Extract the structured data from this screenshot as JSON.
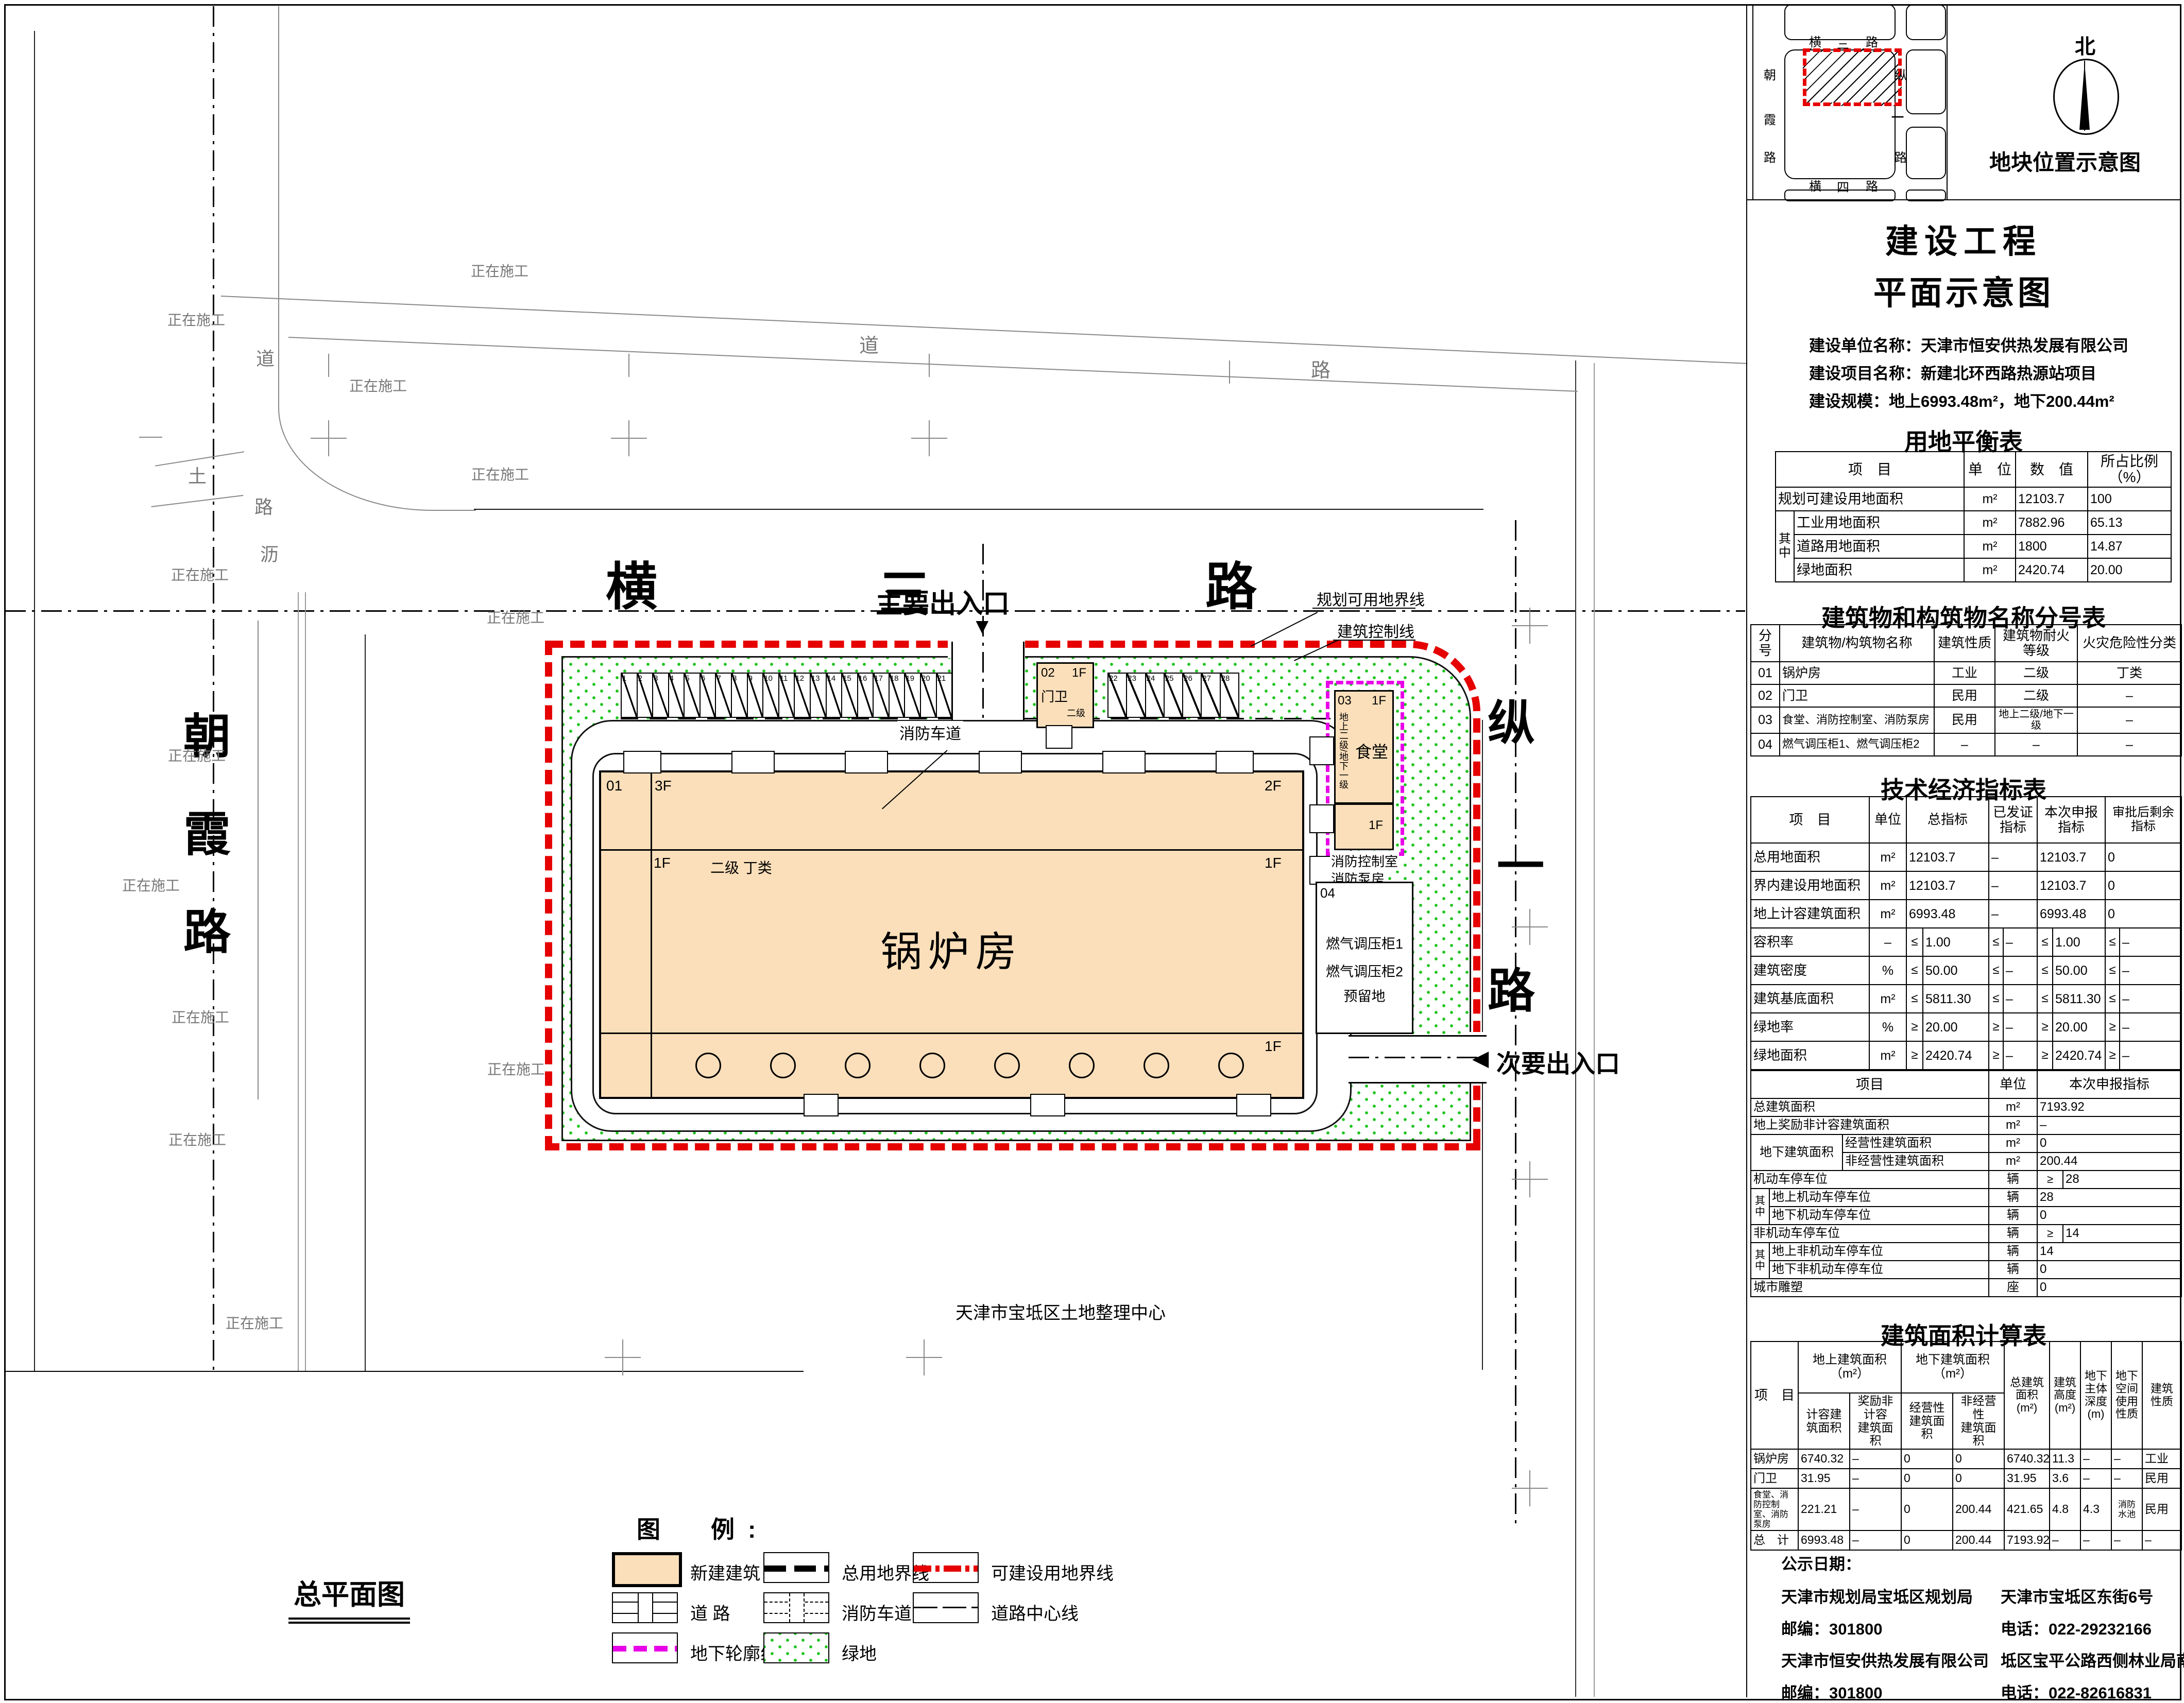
{
  "plan": {
    "under_construction": "正在施工",
    "land_center": "天津市宝坻区土地整理中心",
    "site_plan_title": "总平面图",
    "main_entrance": "主要出入口",
    "secondary_entrance": "次要出入口",
    "boundary_label_1": "规划可用地界线",
    "boundary_label_2": "建筑控制线",
    "fire_lane_label": "消防车道",
    "roads": {
      "heng3": [
        "横",
        "三",
        "路"
      ],
      "zong1": [
        "纵",
        "一",
        "路"
      ],
      "chaoxia": [
        "朝",
        "霞",
        "路"
      ],
      "dirt": "土",
      "dao": "道",
      "lu": "路",
      "li": "沥"
    },
    "boiler": {
      "code": "01",
      "f3": "3F",
      "f2": "2F",
      "f1": "1F",
      "grade": "二级 丁类",
      "name": "锅炉房"
    },
    "guard": {
      "code": "02",
      "f1": "1F",
      "name": "门卫",
      "grade": "二级"
    },
    "canteen": {
      "code": "03",
      "f1": "1F",
      "name": "食堂",
      "grade_note": "地上二级/地下一级",
      "fire_ctrl": "消防控制室",
      "fire_pump": "消防泵房"
    },
    "gas": {
      "code": "04",
      "line1": "燃气调压柜1",
      "line2": "燃气调压柜2",
      "line3": "预留地"
    },
    "parking_row_a": [
      "1",
      "2",
      "3",
      "4",
      "5",
      "6",
      "7",
      "8",
      "9",
      "10",
      "11",
      "12",
      "13",
      "14",
      "15",
      "16",
      "17",
      "18",
      "19",
      "20",
      "21"
    ],
    "parking_row_b": [
      "22",
      "23",
      "24",
      "25",
      "26",
      "27",
      "28"
    ]
  },
  "minimap": {
    "title": "地块位置示意图",
    "north": "北",
    "heng3": [
      "横",
      "三",
      "路"
    ],
    "heng4": [
      "横",
      "四",
      "路"
    ],
    "chaoxia": [
      "朝",
      "霞",
      "路"
    ],
    "zong1_top": "纵",
    "zong1_mid": "一",
    "zong1_bot": "路"
  },
  "titleblock": {
    "line1": "建设工程",
    "line2": "平面示意图",
    "info": [
      "建设单位名称：天津市恒安供热发展有限公司",
      "建设项目名称：新建北环西路热源站项目",
      "建设规模：地上6993.48m²，地下200.44m²"
    ]
  },
  "tables": {
    "land_balance": {
      "title": "用地平衡表",
      "headers": [
        "项　目",
        "单　位",
        "数　值",
        "所占比例（%）"
      ],
      "qizhong": "其中",
      "rows": [
        {
          "item": "规划可建设用地面积",
          "unit": "m²",
          "value": "12103.7",
          "pct": "100"
        },
        {
          "item": "工业用地面积",
          "unit": "m²",
          "value": "7882.96",
          "pct": "65.13"
        },
        {
          "item": "道路用地面积",
          "unit": "m²",
          "value": "1800",
          "pct": "14.87"
        },
        {
          "item": "绿地面积",
          "unit": "m²",
          "value": "2420.74",
          "pct": "20.00"
        }
      ]
    },
    "buildings": {
      "title": "建筑物和构筑物名称分号表",
      "headers": [
        "分号",
        "建筑物/构筑物名称",
        "建筑性质",
        "建筑物耐火等级",
        "火灾危险性分类"
      ],
      "rows": [
        [
          "01",
          "锅炉房",
          "工业",
          "二级",
          "丁类"
        ],
        [
          "02",
          "门卫",
          "民用",
          "二级",
          "–"
        ],
        [
          "03",
          "食堂、消防控制室、消防泵房",
          "民用",
          "地上二级/地下一级",
          "–"
        ],
        [
          "04",
          "燃气调压柜1、燃气调压柜2",
          "–",
          "–",
          "–"
        ]
      ]
    },
    "tech": {
      "title": "技术经济指标表",
      "headers": [
        "项　目",
        "单位",
        "总指标",
        "已发证指标",
        "本次申报指标",
        "审批后剩余指标"
      ],
      "upper_rows": [
        {
          "label": "总用地面积",
          "unit": "m²",
          "cells": [
            [
              "",
              "12103.7"
            ],
            [
              "",
              "–"
            ],
            [
              "",
              "12103.7"
            ],
            [
              "",
              "0"
            ]
          ]
        },
        {
          "label": "界内建设用地面积",
          "unit": "m²",
          "cells": [
            [
              "",
              "12103.7"
            ],
            [
              "",
              "–"
            ],
            [
              "",
              "12103.7"
            ],
            [
              "",
              "0"
            ]
          ]
        },
        {
          "label": "地上计容建筑面积",
          "unit": "m²",
          "cells": [
            [
              "",
              "6993.48"
            ],
            [
              "",
              "–"
            ],
            [
              "",
              "6993.48"
            ],
            [
              "",
              "0"
            ]
          ]
        },
        {
          "label": "容积率",
          "unit": "–",
          "cells": [
            [
              "≤",
              "1.00"
            ],
            [
              "≤",
              "–"
            ],
            [
              "≤",
              "1.00"
            ],
            [
              "≤",
              "–"
            ]
          ]
        },
        {
          "label": "建筑密度",
          "unit": "%",
          "cells": [
            [
              "≤",
              "50.00"
            ],
            [
              "≤",
              "–"
            ],
            [
              "≤",
              "50.00"
            ],
            [
              "≤",
              "–"
            ]
          ]
        },
        {
          "label": "建筑基底面积",
          "unit": "m²",
          "cells": [
            [
              "≤",
              "5811.30"
            ],
            [
              "≤",
              "–"
            ],
            [
              "≤",
              "5811.30"
            ],
            [
              "≤",
              "–"
            ]
          ]
        },
        {
          "label": "绿地率",
          "unit": "%",
          "cells": [
            [
              "≥",
              "20.00"
            ],
            [
              "≥",
              "–"
            ],
            [
              "≥",
              "20.00"
            ],
            [
              "≥",
              "–"
            ]
          ]
        },
        {
          "label": "绿地面积",
          "unit": "m²",
          "cells": [
            [
              "≥",
              "2420.74"
            ],
            [
              "≥",
              "–"
            ],
            [
              "≥",
              "2420.74"
            ],
            [
              "≥",
              "–"
            ]
          ]
        }
      ],
      "sub_headers": [
        "项目",
        "单位",
        "本次申报指标"
      ],
      "group_label": "地下建筑面积",
      "qizhong": "其中",
      "lower_rows": [
        {
          "type": "plain",
          "label": "总建筑面积",
          "unit": "m²",
          "value": "7193.92"
        },
        {
          "type": "plain",
          "label": "地上奖励非计容建筑面积",
          "unit": "m²",
          "value": "–"
        },
        {
          "type": "groupstart",
          "label": "经营性建筑面积",
          "unit": "m²",
          "value": "0"
        },
        {
          "type": "groupend",
          "label": "非经营性建筑面积",
          "unit": "m²",
          "value": "200.44"
        },
        {
          "type": "signed",
          "label": "机动车停车位",
          "unit": "辆",
          "sign": "≥",
          "value": "28"
        },
        {
          "type": "qzstart",
          "label": "地上机动车停车位",
          "unit": "辆",
          "value": "28"
        },
        {
          "type": "qzend",
          "label": "地下机动车停车位",
          "unit": "辆",
          "value": "0"
        },
        {
          "type": "signed",
          "label": "非机动车停车位",
          "unit": "辆",
          "sign": "≥",
          "value": "14"
        },
        {
          "type": "qzstart",
          "label": "地上非机动车停车位",
          "unit": "辆",
          "value": "14"
        },
        {
          "type": "qzend",
          "label": "地下非机动车停车位",
          "unit": "辆",
          "value": "0"
        },
        {
          "type": "plain",
          "label": "城市雕塑",
          "unit": "座",
          "value": "0"
        }
      ]
    },
    "area": {
      "title": "建筑面积计算表",
      "col_project": "项　目",
      "group_above": "地上建筑面积（m²）",
      "group_below": "地下建筑面积（m²）",
      "sub": [
        "计容建\n筑面积",
        "奖励非计容\n建筑面积",
        "经营性\n建筑面积",
        "非经营性\n建筑面积"
      ],
      "tall": [
        "总建筑\n面积\n(m²)",
        "建筑\n高度\n(m²)",
        "地下\n主体\n深度\n(m)",
        "地下\n空间\n使用\n性质",
        "建筑\n性质"
      ],
      "rows": [
        [
          "锅炉房",
          "6740.32",
          "–",
          "0",
          "0",
          "6740.32",
          "11.3",
          "–",
          "–",
          "工业"
        ],
        [
          "门卫",
          "31.95",
          "–",
          "0",
          "0",
          "31.95",
          "3.6",
          "–",
          "–",
          "民用"
        ],
        [
          "食堂、消防控制室、消防泵房",
          "221.21",
          "–",
          "0",
          "200.44",
          "421.65",
          "4.8",
          "4.3",
          "消防\n水池",
          "民用"
        ],
        [
          "总　计",
          "6993.48",
          "–",
          "0",
          "200.44",
          "7193.92",
          "–",
          "–",
          "–",
          "–"
        ]
      ]
    }
  },
  "legend": {
    "title": "图　例:",
    "new_building": "新建建筑",
    "total_boundary": "总用地界线",
    "buildable_boundary": "可建设用地界线",
    "road": "道 路",
    "fire_lane": "消防车道",
    "road_center": "道路中心线",
    "underground": "地下轮廓线",
    "green": "绿地"
  },
  "contact": {
    "publish": "公示日期：",
    "left": [
      "天津市规划局宝坻区规划局",
      "邮编：301800",
      "天津市恒安供热发展有限公司",
      "邮编：301800"
    ],
    "right": [
      "天津市宝坻区东街6号",
      "电话：022-29232166",
      "坻区宝平公路西侧林业局南侧",
      "电话：022-82616831"
    ]
  }
}
